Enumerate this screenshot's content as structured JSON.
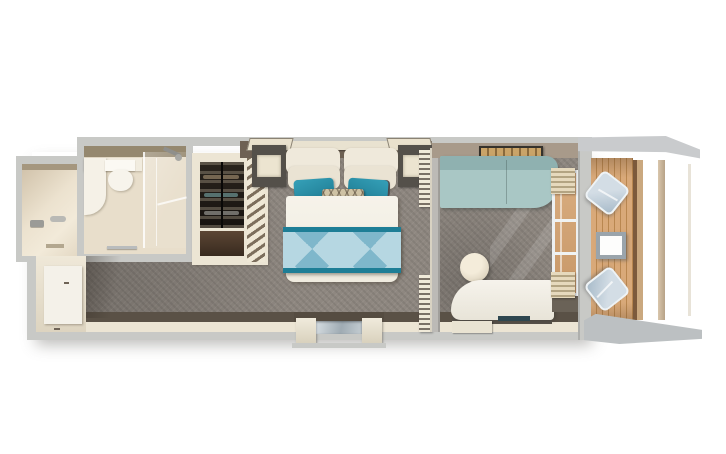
{
  "meta": {
    "description": "Top-down 3D floor plan render of a cruise-ship balcony stateroom",
    "text_content": "none-visible"
  },
  "palette": {
    "bg": "#ffffff",
    "wall_outer": "#c8c9c6",
    "wall_face_cream": "#ece5d4",
    "wall_face_dark": "#5a5146",
    "headwall_dark": "#6e6154",
    "bath_floor": "#e8decb",
    "bath_wall_band": "#95886f",
    "carpet": "#8e8780",
    "sofa_teal": "#a9c7c5",
    "throw_light": "#b6d7e2",
    "throw_mid": "#7fb7cb",
    "throw_border": "#1e7e96",
    "pillow_teal": "#2a8fa8",
    "deck_wood": "#d9a979",
    "deck_line": "#b98750",
    "chair_blue": "#b9c9d7",
    "curtain_beige": "#d9cba9",
    "door_sill_metal": "#9fabb3"
  },
  "rooms": {
    "shower_room": {
      "items": [
        "shower-controls",
        "hand-shower",
        "drain"
      ]
    },
    "bathroom": {
      "items": [
        "vanity-counter",
        "toilet",
        "glass-shower-enclosure",
        "shower-head",
        "towel-bar"
      ]
    },
    "wardrobe": {
      "items": [
        "hanging-clothes",
        "lower-cabinet",
        "angled-shelf-tower"
      ]
    },
    "bedroom": {
      "items": [
        "queen-bed",
        "cream-pillows-x4",
        "teal-pillows-x2",
        "gray-pillows-x2",
        "patterned-accent-pillow",
        "white-duvet",
        "diamond-pattern-throw",
        "nightstand-left",
        "nightstand-right",
        "headboard-shelf",
        "louvered-shelf-top",
        "louvered-shelf-bottom",
        "entry-door-alcove",
        "bathroom-door-panel"
      ]
    },
    "sitting_room": {
      "items": [
        "teal-sofa",
        "round-ottoman",
        "chaise-lounge",
        "ceiling-light-fixture",
        "balcony-sliding-door",
        "curtains",
        "door-mat"
      ]
    },
    "balcony": {
      "items": [
        "wood-plank-deck",
        "deck-chair-x2",
        "square-side-table",
        "railing",
        "privacy-partition-top",
        "privacy-partition-bottom"
      ]
    }
  }
}
